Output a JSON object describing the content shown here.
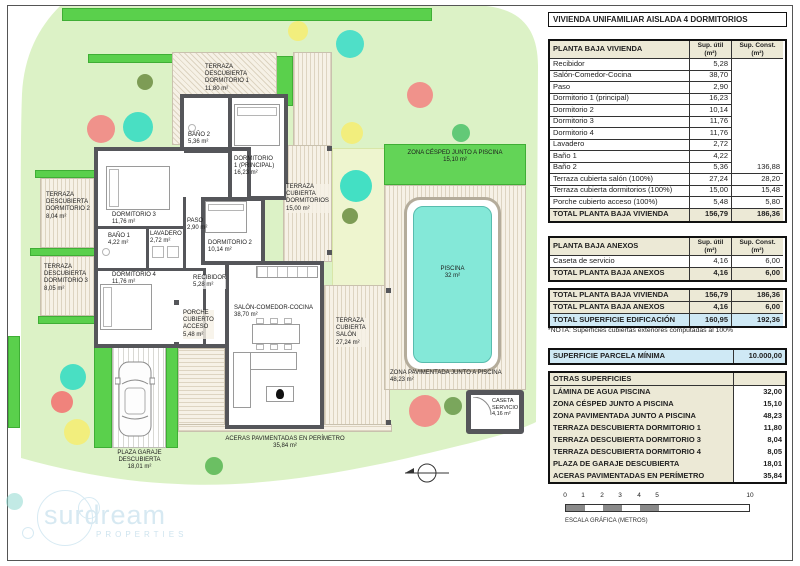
{
  "sheet": {
    "title": "VIVIENDA UNIFAMILIAR AISLADA 4 DORMITORIOS"
  },
  "tables": {
    "vivienda": {
      "title": "PLANTA BAJA VIVIENDA",
      "col_util": "Sup. útil\n(m²)",
      "col_const": "Sup. Const.\n(m²)",
      "rows": [
        [
          "Recibidor",
          "5,28",
          ""
        ],
        [
          "Salón-Comedor-Cocina",
          "38,70",
          ""
        ],
        [
          "Paso",
          "2,90",
          ""
        ],
        [
          "Dormitorio 1 (principal)",
          "16,23",
          ""
        ],
        [
          "Dormitorio 2",
          "10,14",
          ""
        ],
        [
          "Dormitorio 3",
          "11,76",
          ""
        ],
        [
          "Dormitorio 4",
          "11,76",
          ""
        ],
        [
          "Lavadero",
          "2,72",
          ""
        ],
        [
          "Baño 1",
          "4,22",
          ""
        ],
        [
          "Baño 2",
          "5,36",
          "136,88"
        ],
        [
          "Terraza cubierta salón (100%)",
          "27,24",
          "28,20"
        ],
        [
          "Terraza cubierta dormitorios (100%)",
          "15,00",
          "15,48"
        ],
        [
          "Porche cubierto acceso (100%)",
          "5,48",
          "5,80"
        ]
      ],
      "total": [
        "TOTAL PLANTA BAJA VIVIENDA",
        "156,79",
        "186,36"
      ]
    },
    "anexos": {
      "title": "PLANTA BAJA ANEXOS",
      "col_util": "Sup. útil\n(m²)",
      "col_const": "Sup. Const.\n(m²)",
      "rows": [
        [
          "Caseta de servicio",
          "4,16",
          "6,00"
        ]
      ],
      "total": [
        "TOTAL PLANTA BAJA ANEXOS",
        "4,16",
        "6,00"
      ]
    },
    "summary": {
      "rows": [
        [
          "TOTAL PLANTA BAJA VIVIENDA",
          "156,79",
          "186,36"
        ],
        [
          "TOTAL PLANTA BAJA ANEXOS",
          "4,16",
          "6,00"
        ],
        [
          "TOTAL SUPERFICIE EDIFICACIÓN",
          "160,95",
          "192,36"
        ]
      ],
      "note": "*NOTA: Superficies cubiertas exteriores computadas al 100%"
    },
    "parcela": {
      "label": "SUPERFICIE PARCELA MÍNIMA",
      "value": "10.000,00"
    },
    "otras": {
      "title": "OTRAS SUPERFICIES",
      "rows": [
        [
          "LÁMINA DE AGUA PISCINA",
          "32,00"
        ],
        [
          "ZONA CÉSPED JUNTO A PISCINA",
          "15,10"
        ],
        [
          "ZONA PAVIMENTADA JUNTO A PISCINA",
          "48,23"
        ],
        [
          "TERRAZA DESCUBIERTA DORMITORIO 1",
          "11,80"
        ],
        [
          "TERRAZA DESCUBIERTA DORMITORIO 3",
          "8,04"
        ],
        [
          "TERRAZA DESCUBIERTA DORMITORIO 4",
          "8,05"
        ],
        [
          "PLAZA DE GARAJE DESCUBIERTA",
          "18,01"
        ],
        [
          "ACERAS PAVIMENTADAS EN PERÍMETRO",
          "35,84"
        ]
      ]
    }
  },
  "plan": {
    "labels": {
      "terraza_desc_dorm1": "TERRAZA\nDESCUBIERTA\nDORMITORIO 1\n11,80 m²",
      "terraza_desc_dorm2": "TERRAZA\nDESCUBIERTA\nDORMITORIO 2\n8,04 m²",
      "terraza_desc_dorm3": "TERRAZA\nDESCUBIERTA\nDORMITORIO 3\n8,05 m²",
      "bano2": "BAÑO 2\n5,36 m²",
      "dorm1": "DORMITORIO\n1 (PRINCIPAL)\n16,23 m²",
      "dorm3": "DORMITORIO 3\n11,76 m²",
      "paso": "PASO\n2,90 m²",
      "bano1": "BAÑO 1\n4,22 m²",
      "lavadero": "LAVADERO\n2,72 m²",
      "dorm2": "DORMITORIO 2\n10,14 m²",
      "dorm4": "DORMITORIO 4\n11,76 m²",
      "recibidor": "RECIBIDOR\n5,28 m²",
      "salon": "SALÓN-COMEDOR-COCINA\n38,70 m²",
      "terraza_cub_dorms": "TERRAZA\nCUBIERTA\nDORMITORIOS\n15,00 m²",
      "terraza_cub_salon": "TERRAZA\nCUBIERTA\nSALÓN\n27,24 m²",
      "porche": "PORCHE\nCUBIERTO\nACCESO\n5,48 m²",
      "cesped": "ZONA CÉSPED JUNTO A PISCINA\n15,10 m²",
      "piscina": "PISCINA\n32 m²",
      "pav": "ZONA PAVIMENTADA JUNTO A PISCINA\n48,23 m²",
      "caseta": "CASETA\nSERVICIO\n4,16 m²",
      "garaje": "PLAZA GARAJE\nDESCUBIERTA\n18,01 m²",
      "aceras": "ACERAS PAVIMENTADAS EN PERÍMETRO\n35,84 m²"
    }
  },
  "scalebar": {
    "ticks": [
      "0",
      "1",
      "2",
      "3",
      "4",
      "5",
      "10"
    ],
    "label": "ESCALA GRÁFICA (METROS)"
  },
  "logo": {
    "name": "surdream",
    "sub": "PROPERTIES"
  },
  "colors": {
    "garden": "#dcf2c6",
    "hedge": "#5ad04c",
    "pool_water": "#84e8d8",
    "wall": "#55565a",
    "table_beige": "#ece9d6",
    "table_blue": "#cfe9f5",
    "tree_pink": "#f0928b",
    "tree_teal": "#49dfc3",
    "tree_yellow": "#f2ee7d",
    "tree_olive": "#7d9c55",
    "tree_green": "#62c977"
  }
}
